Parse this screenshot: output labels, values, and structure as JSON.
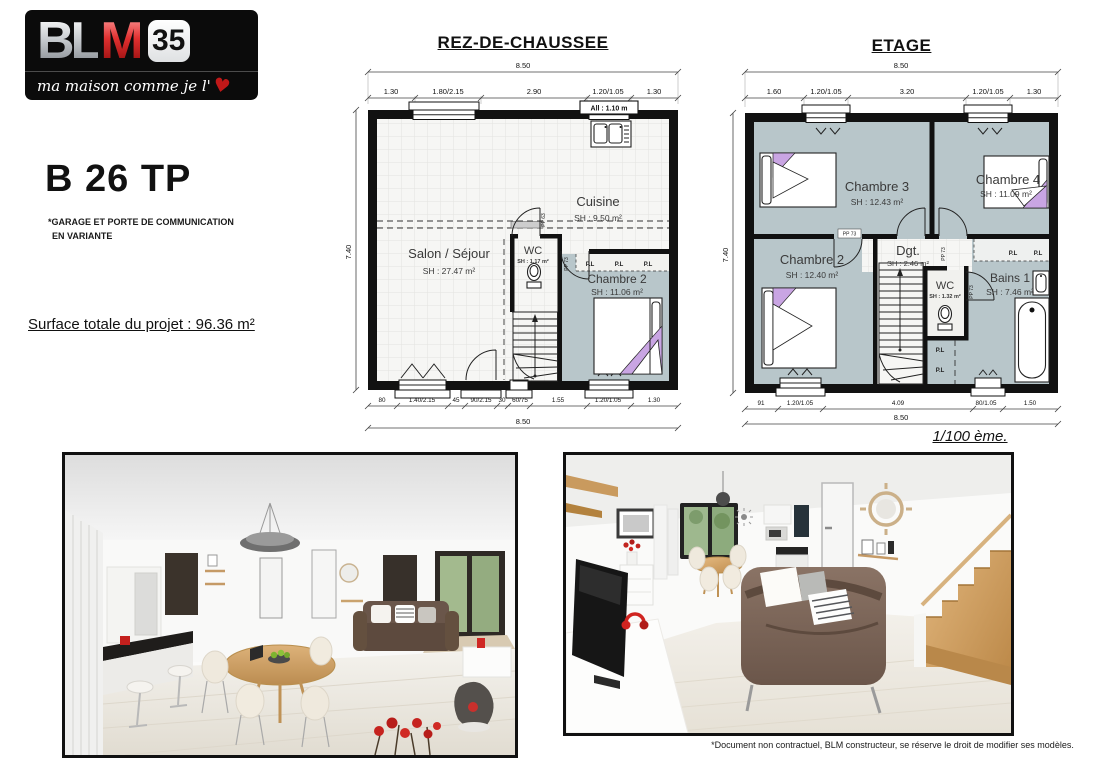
{
  "logo": {
    "brand_bl": "BL",
    "brand_m": "M",
    "dept": "35",
    "tagline": "ma maison comme je l'",
    "heart": "♥"
  },
  "header": {
    "model": "B 26 TP",
    "note_line1": "*GARAGE ET PORTE DE COMMUNICATION",
    "note_line2": "EN VARIANTE",
    "surface_total": "Surface totale du projet : 96.36 m²"
  },
  "plans": {
    "scale_note": "1/100 ème.",
    "rdc": {
      "title": "REZ-DE-CHAUSSEE",
      "dim_total_top": "8.50",
      "dim_total_bottom": "8.50",
      "dim_left": "7.40",
      "dims_top": [
        "1.30",
        "1.80/2.15",
        "2.90",
        "1.20/1.05",
        "1.30"
      ],
      "dims_bottom": [
        "80",
        "1.40/2.15",
        "45",
        "90/2.15",
        "30",
        "60/75",
        "1.55",
        "1.20/1.05",
        "1.30"
      ],
      "rooms": {
        "cuisine": {
          "name": "Cuisine",
          "area": "SH : 9.50 m²"
        },
        "salon": {
          "name": "Salon / Séjour",
          "area": "SH : 27.47 m²"
        },
        "wc": {
          "name": "WC",
          "area": "SH : 1.17 m²"
        },
        "chambre2": {
          "name": "Chambre 2",
          "area": "SH : 11.06 m²"
        }
      },
      "labels": {
        "allege": "All : 1.10 m",
        "pp63": "PP 63",
        "pp73": "PP 73",
        "pl": "P.L"
      }
    },
    "etage": {
      "title": "ETAGE",
      "dim_total_top": "8.50",
      "dim_total_bottom": "8.50",
      "dim_left": "7.40",
      "dims_top": [
        "1.60",
        "1.20/1.05",
        "3.20",
        "1.20/1.05",
        "1.30"
      ],
      "dims_bottom": [
        "91",
        "1.20/1.05",
        "4.09",
        "80/1.05",
        "1.50"
      ],
      "rooms": {
        "chambre3": {
          "name": "Chambre 3",
          "area": "SH : 12.43 m²"
        },
        "chambre4": {
          "name": "Chambre 4",
          "area": "SH : 11.09 m²"
        },
        "chambre2": {
          "name": "Chambre 2",
          "area": "SH : 12.40 m²"
        },
        "dgt": {
          "name": "Dgt.",
          "area": "SH : 2.46 m²"
        },
        "wc": {
          "name": "WC",
          "area": "SH : 1.32 m²"
        },
        "bains": {
          "name": "Bains 1",
          "area": "SH : 7.46 m²"
        }
      },
      "labels": {
        "pp73": "PP 73",
        "pl": "P.L"
      }
    }
  },
  "footer": {
    "disclaimer": "*Document non contractuel, BLM constructeur, se réserve le droit de modifier ses modèles."
  },
  "colors": {
    "brand-red": "#c01818",
    "room-fill": "#b8c6ca",
    "pillow-purple": "#c9a5e3",
    "wall": "#111111"
  }
}
